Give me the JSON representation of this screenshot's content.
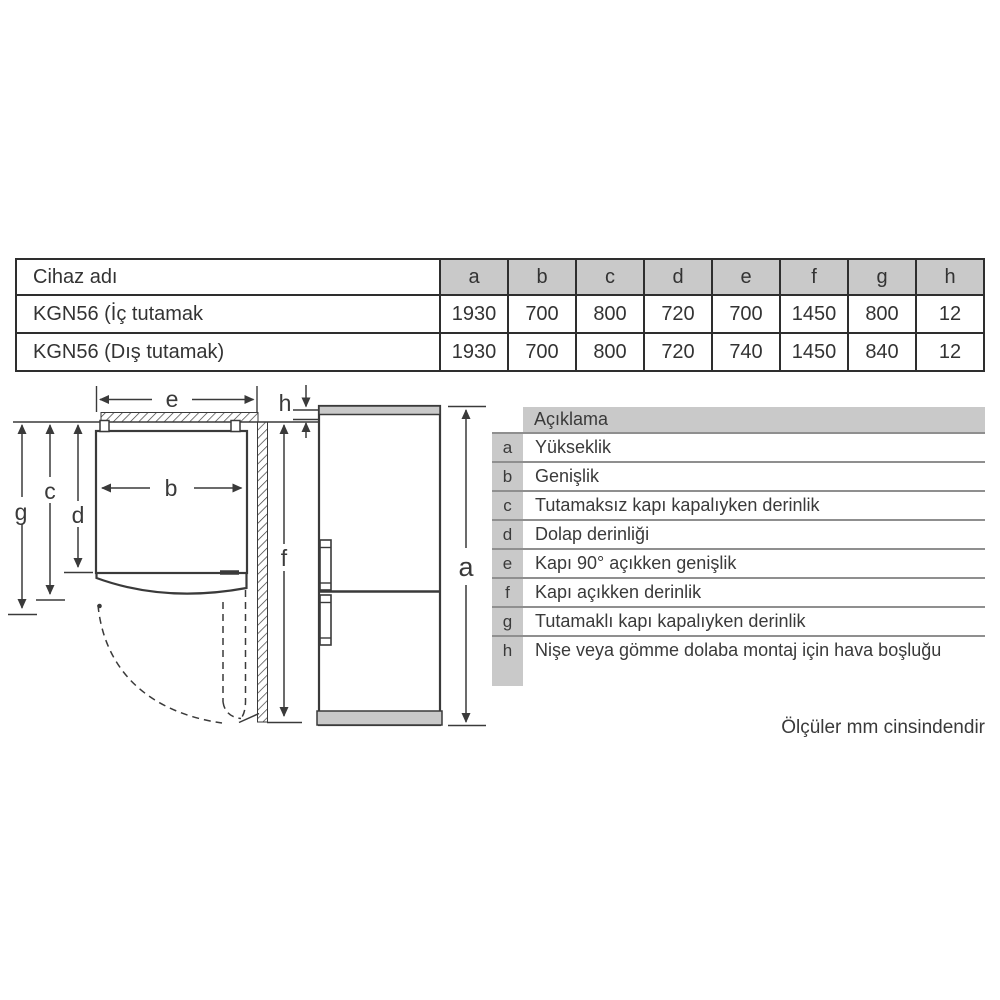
{
  "dimension_table": {
    "device_column_header": "Cihaz adı",
    "column_headers": [
      "a",
      "b",
      "c",
      "d",
      "e",
      "f",
      "g",
      "h"
    ],
    "rows": [
      {
        "device": "KGN56 (İç tutamak",
        "values": [
          "1930",
          "700",
          "800",
          "720",
          "700",
          "1450",
          "800",
          "12"
        ]
      },
      {
        "device": "KGN56 (Dış tutamak)",
        "values": [
          "1930",
          "700",
          "800",
          "720",
          "740",
          "1450",
          "840",
          "12"
        ]
      }
    ]
  },
  "diagram": {
    "labels": {
      "a": "a",
      "b": "b",
      "c": "c",
      "d": "d",
      "e": "e",
      "f": "f",
      "g": "g",
      "h": "h"
    }
  },
  "legend": {
    "header": "Açıklama",
    "rows": [
      {
        "key": "a",
        "text": "Yükseklik"
      },
      {
        "key": "b",
        "text": "Genişlik"
      },
      {
        "key": "c",
        "text": "Tutamaksız kapı kapalıyken derinlik"
      },
      {
        "key": "d",
        "text": "Dolap derinliği"
      },
      {
        "key": "e",
        "text": "Kapı 90° açıkken genişlik"
      },
      {
        "key": "f",
        "text": "Kapı açıkken derinlik"
      },
      {
        "key": "g",
        "text": "Tutamaklı kapı kapalıyken derinlik"
      },
      {
        "key": "h",
        "text": "Nişe veya gömme dolaba montaj için hava boşluğu"
      }
    ]
  },
  "footer": {
    "note": "Ölçüler mm cinsindendir"
  },
  "colors": {
    "line": "#3a3a3a",
    "fill_gray": "#c9c9c9",
    "table_border": "#2e2e2e",
    "separator": "#8f8f8f"
  }
}
